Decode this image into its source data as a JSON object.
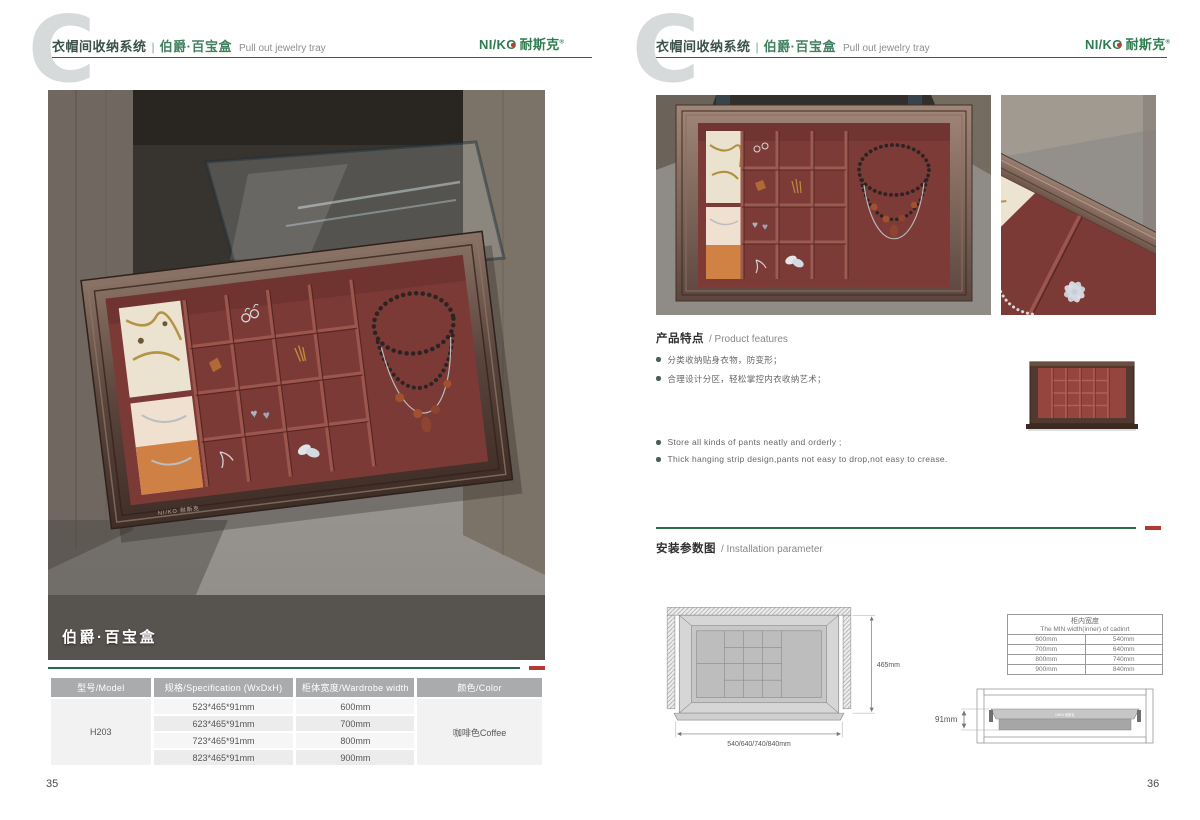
{
  "brand": {
    "latin": "NI/KO",
    "zh": "耐斯克",
    "reg": "®"
  },
  "header": {
    "letter": "C",
    "series_zh": "衣帽间收纳系统",
    "separator": "|",
    "product_zh": "伯爵·百宝盒",
    "product_en": "Pull out jewelry tray"
  },
  "watermark": "NI/KO 耐斯克",
  "page_left": {
    "page_number": "35",
    "photo_caption": "伯爵·百宝盒",
    "spec_table": {
      "headers": [
        "型号/Model",
        "规格/Specification (WxDxH)",
        "柜体宽度/Wardrobe width",
        "颜色/Color"
      ],
      "model": "H203",
      "rows": [
        {
          "spec": "523*465*91mm",
          "width": "600mm"
        },
        {
          "spec": "623*465*91mm",
          "width": "700mm"
        },
        {
          "spec": "723*465*91mm",
          "width": "800mm"
        },
        {
          "spec": "823*465*91mm",
          "width": "900mm"
        }
      ],
      "color": "咖啡色Coffee"
    }
  },
  "page_right": {
    "page_number": "36",
    "features": {
      "title_zh": "产品特点",
      "title_en": "/ Product features",
      "bullets_zh": [
        "分类收纳贴身衣物，防变形；",
        "合理设计分区，轻松掌控内衣收纳艺术；"
      ],
      "bullets_en": [
        "Store all kinds of pants neatly and orderly ;",
        "Thick hanging strip design,pants not easy to drop,not easy to crease."
      ]
    },
    "installation": {
      "title_zh": "安装参数图",
      "title_en": "/ Installation parameter",
      "top_view": {
        "depth_label": "465mm",
        "width_label": "540/640/740/840mm"
      },
      "side_view": {
        "height_label": "91mm"
      },
      "min_width_table": {
        "title_zh": "柜内宽度",
        "title_en": "The MIN width(inner) of cadinrt",
        "rows": [
          {
            "wardrobe": "600mm",
            "inner": "540mm"
          },
          {
            "wardrobe": "700mm",
            "inner": "640mm"
          },
          {
            "wardrobe": "800mm",
            "inner": "740mm"
          },
          {
            "wardrobe": "900mm",
            "inner": "840mm"
          }
        ]
      }
    }
  }
}
